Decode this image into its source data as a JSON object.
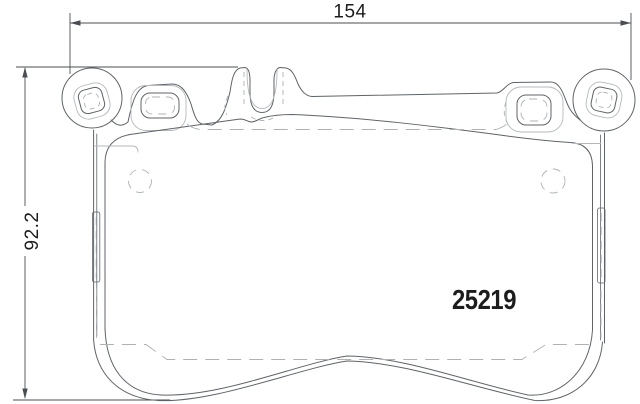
{
  "colors": {
    "bg": "#ffffff",
    "outline": "#5f6368",
    "light": "#b4b8bb",
    "hidden": "#aeb2b5",
    "dim": "#4a4e52",
    "text": "#1d1d1d"
  },
  "dimensions": {
    "width": {
      "label": "154"
    },
    "height": {
      "label": "92.2"
    }
  },
  "part": {
    "number": "25219"
  }
}
